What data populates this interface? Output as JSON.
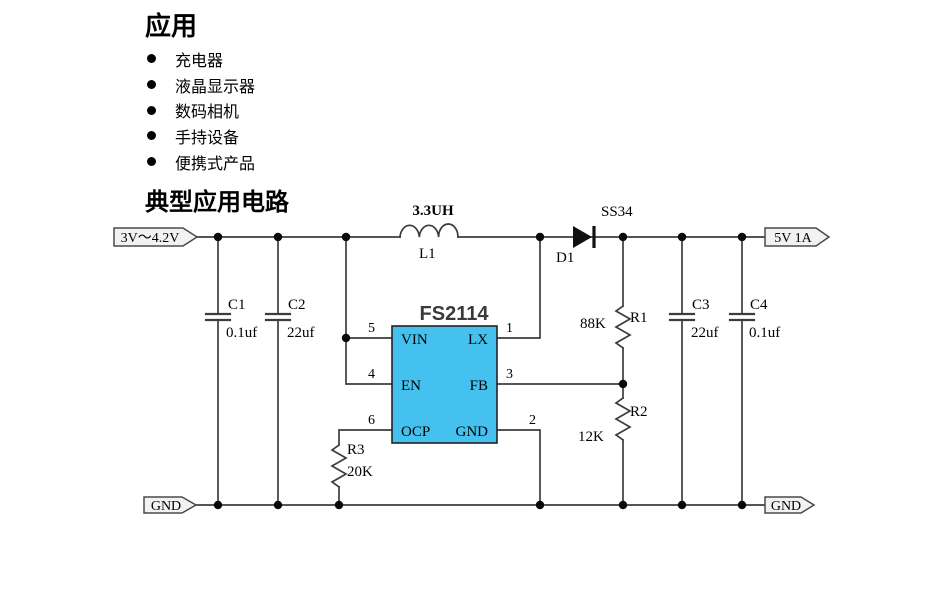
{
  "page": {
    "applications_heading": "应用",
    "applications": [
      "充电器",
      "液晶显示器",
      "数码相机",
      "手持设备",
      "便携式产品"
    ],
    "circuit_heading": "典型应用电路"
  },
  "circuit": {
    "input_flag": "3V～4.2V",
    "output_flag": "5V 1A",
    "gnd_left_flag": "GND",
    "gnd_right_flag": "GND",
    "inductor": {
      "ref": "L1",
      "value": "3.3UH"
    },
    "diode": {
      "ref": "D1",
      "part": "SS34"
    },
    "capacitors": [
      {
        "ref": "C1",
        "value": "0.1uf"
      },
      {
        "ref": "C2",
        "value": "22uf"
      },
      {
        "ref": "C3",
        "value": "22uf"
      },
      {
        "ref": "C4",
        "value": "0.1uf"
      }
    ],
    "resistors": [
      {
        "ref": "R1",
        "value": "88K"
      },
      {
        "ref": "R2",
        "value": "12K"
      },
      {
        "ref": "R3",
        "value": "20K"
      }
    ],
    "ic": {
      "name": "FS2114",
      "pins_left": [
        {
          "num": "5",
          "label": "VIN"
        },
        {
          "num": "4",
          "label": "EN"
        },
        {
          "num": "6",
          "label": "OCP"
        }
      ],
      "pins_right": [
        {
          "num": "1",
          "label": "LX"
        },
        {
          "num": "3",
          "label": "FB"
        },
        {
          "num": "2",
          "label": "GND"
        }
      ]
    },
    "colors": {
      "ic_fill": "#45c1ef",
      "wire": "#3d3d3d",
      "flag_fill": "#f2f2f2",
      "dot": "#0a0a0a"
    }
  }
}
